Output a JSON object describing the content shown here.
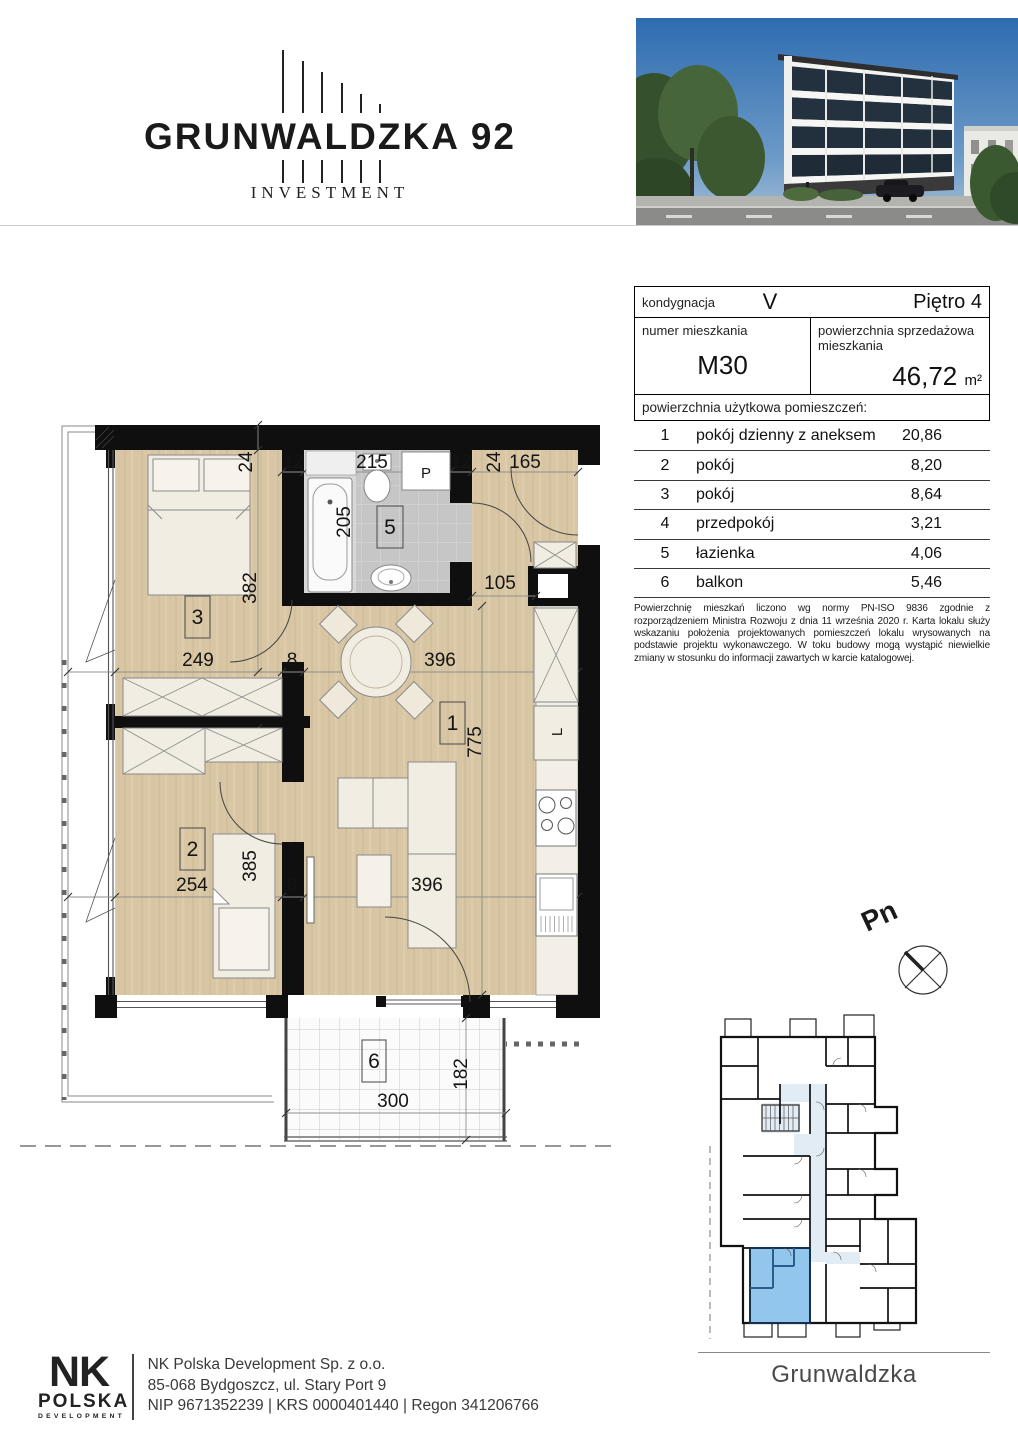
{
  "brand": {
    "wordmark": "GRUNWALDZKA 92",
    "subtitle": "INVESTMENT"
  },
  "info": {
    "kondygnacja_label": "kondygnacja",
    "kondygnacja_value": "V",
    "pietro_value": "Piętro 4",
    "numer_label": "numer mieszkania",
    "numer_value": "M30",
    "powierzchnia_label": "powierzchnia sprzedażowa mieszkania",
    "powierzchnia_value": "46,72",
    "powierzchnia_unit": "m²",
    "uzytkowa_header": "powierzchnia użytkowa pomieszczeń:",
    "rooms": [
      {
        "no": "1",
        "name": "pokój dzienny z aneksem",
        "area": "20,86"
      },
      {
        "no": "2",
        "name": "pokój",
        "area": "8,20"
      },
      {
        "no": "3",
        "name": "pokój",
        "area": "8,64"
      },
      {
        "no": "4",
        "name": "przedpokój",
        "area": "3,21"
      },
      {
        "no": "5",
        "name": "łazienka",
        "area": "4,06"
      },
      {
        "no": "6",
        "name": "balkon",
        "area": "5,46"
      }
    ],
    "disclaimer": "Powierzchnię mieszkań liczono wg normy PN-ISO 9836 zgodnie z rozporządzeniem Ministra Rozwoju z dnia 11 września 2020 r. Karta lokalu służy wskazaniu położenia projektowanych pomieszczeń lokalu wrysowanych na podstawie projektu wykonawczego. W toku budowy mogą wystąpić niewielkie zmiany w stosunku do informacji zawartych w karcie katalogowej."
  },
  "plan": {
    "r1": "1",
    "r2": "2",
    "r3": "3",
    "r5": "5",
    "r6": "6",
    "d24l": "24",
    "d12l": "12",
    "d215": "215",
    "d12r": "12",
    "d24r": "24",
    "d165": "165",
    "d205": "205",
    "d382": "382",
    "d105": "105",
    "d249": "249",
    "d8t": "8",
    "d396t": "396",
    "d775": "775",
    "d254": "254",
    "d385": "385",
    "d8b": "8",
    "d396b": "396",
    "d300": "300",
    "d182": "182",
    "washer": "P",
    "fridge": "L",
    "north": "Pn"
  },
  "mini_plan": {
    "street": "Grunwaldzka"
  },
  "footer": {
    "nk": "NK",
    "polska": "POLSKA",
    "development": "DEVELOPMENT",
    "line1": "NK Polska Development Sp. z o.o.",
    "line2": "85-068 Bydgoszcz, ul. Stary Port 9",
    "line3": "NIP 9671352239 | KRS 0000401440 | Regon 341206766"
  },
  "colors": {
    "floor_wood": "#d9c6a4",
    "tile": "#c9c9c9",
    "wall": "#0f0f0f",
    "unit_highlight": "#92c6ec",
    "corridor": "#e2ecf4"
  }
}
